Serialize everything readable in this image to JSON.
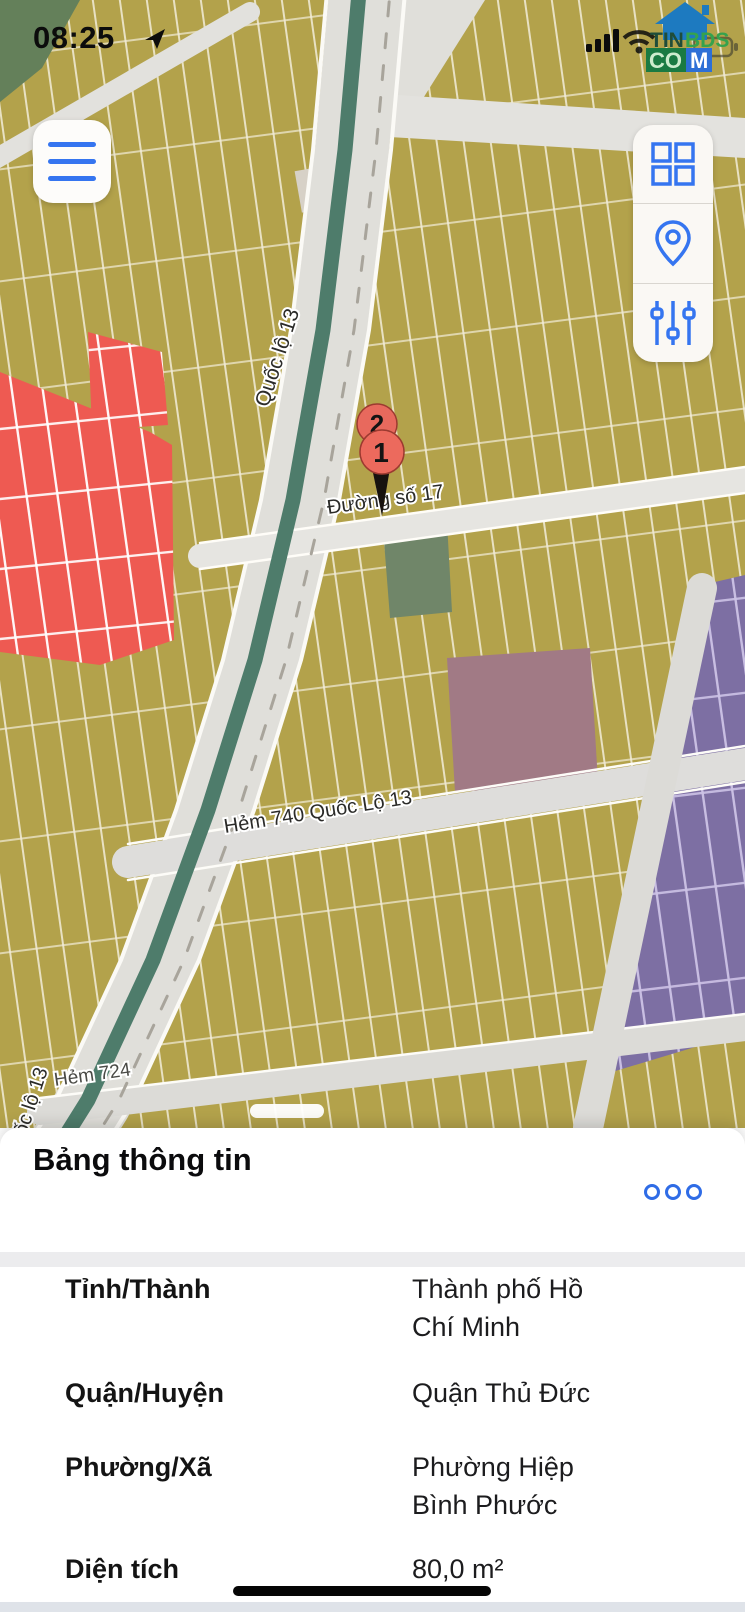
{
  "status_bar": {
    "time": "08:25"
  },
  "logo": {
    "part1": "TIN",
    "part2": "BDS",
    "part3": "CO",
    "part4": "M"
  },
  "map": {
    "labels": {
      "ql13_top": "Quốc lộ 13",
      "duong17": "Đường số 17",
      "hem740": "Hẻm 740 Quốc Lộ 13",
      "ql13_bottom": "Quốc lộ 13",
      "hem724": "Hẻm 724"
    },
    "markers": {
      "back": "2",
      "front": "1"
    }
  },
  "sheet": {
    "title": "Bảng thông tin",
    "rows": [
      {
        "label": "Tỉnh/Thành",
        "value": "Thành phố Hồ Chí Minh"
      },
      {
        "label": "Quận/Huyện",
        "value": "Quận Thủ Đức"
      },
      {
        "label": "Phường/Xã",
        "value": "Phường Hiệp Bình Phước"
      },
      {
        "label": "Diện tích",
        "value": "80,0 m²"
      }
    ]
  },
  "colors": {
    "accent_blue": "#3575f0",
    "marker_red": "#ec6a5d",
    "parcel_olive": "#b3a24b",
    "parcel_red": "#ee5a52",
    "parcel_purple": "#7d6fa3",
    "parcel_mauve": "#a17a85",
    "parcel_green": "#708669",
    "highway_green": "#4e7c6b"
  }
}
